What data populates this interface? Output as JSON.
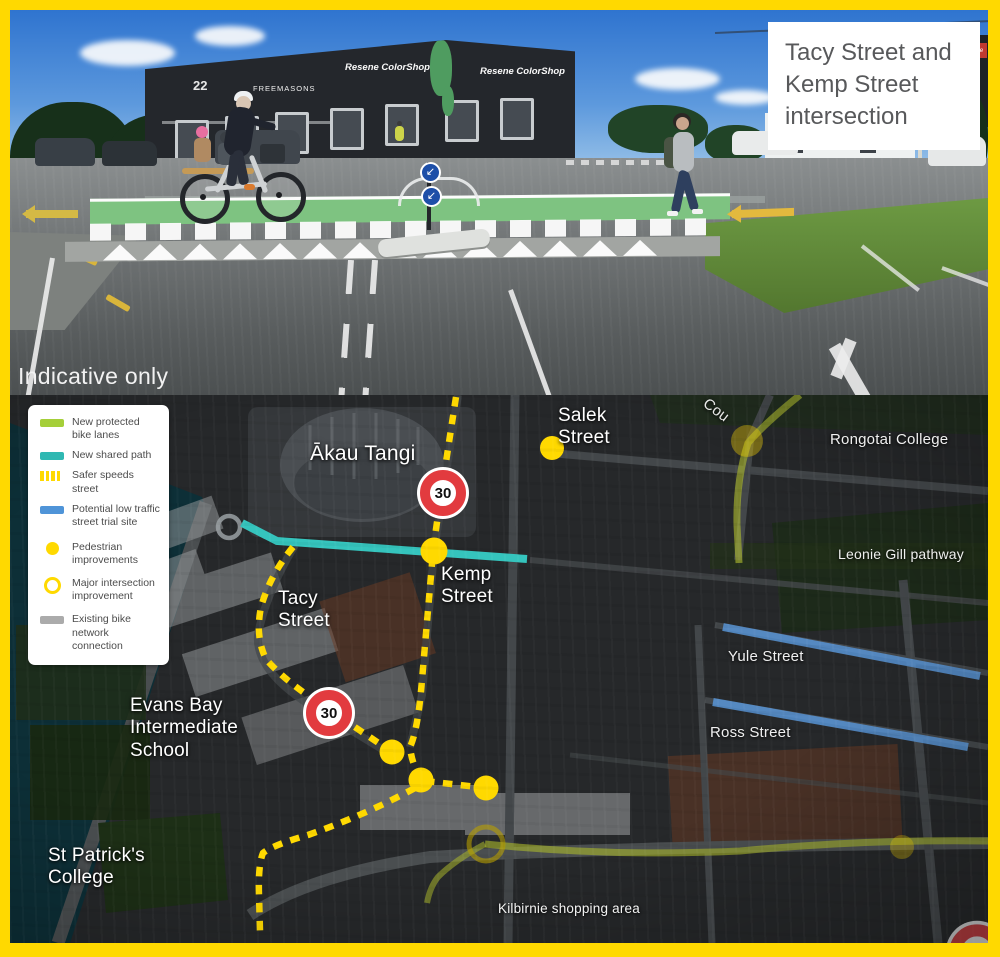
{
  "frame": {
    "border_color": "#ffd900"
  },
  "photo": {
    "caption": "Tacy Street and Kemp Street intersection",
    "watermark": "Indicative only",
    "signs": {
      "building_number": "22",
      "freemasons": "FREEMASONS",
      "resene_a": "Resene ColorShop",
      "resene_b": "Resene ColorShop",
      "resene_c": "Resene"
    }
  },
  "legend": {
    "items": [
      {
        "label": "New protected bike lanes",
        "type": "line",
        "color": "#a5cf39"
      },
      {
        "label": "New shared path",
        "type": "line",
        "color": "#2fb8b2"
      },
      {
        "label": "Safer speeds street",
        "type": "dashed",
        "color": "#ffd900"
      },
      {
        "label": "Potential low traffic street trial site",
        "type": "line",
        "color": "#4f94d8"
      },
      {
        "label": "Pedestrian improvements",
        "type": "dot",
        "color": "#ffd900"
      },
      {
        "label": "Major intersection improvement",
        "type": "ring",
        "color": "#ffd900"
      },
      {
        "label": "Existing bike network connection",
        "type": "line",
        "color": "#ababab"
      }
    ]
  },
  "map": {
    "speed_limit": "30",
    "labels": {
      "akau_tangi": "Ākau Tangi",
      "salek": "Salek Street",
      "kemp": "Kemp Street",
      "tacy": "Tacy Street",
      "evans_bay": "Evans Bay Intermediate School",
      "st_patricks": "St Patrick's College",
      "rongotai": "Rongotai College",
      "leonie": "Leonie Gill pathway",
      "yule": "Yule Street",
      "ross": "Ross Street",
      "kilbirnie": "Kilbirnie shopping area",
      "coutts": "Cou"
    }
  }
}
